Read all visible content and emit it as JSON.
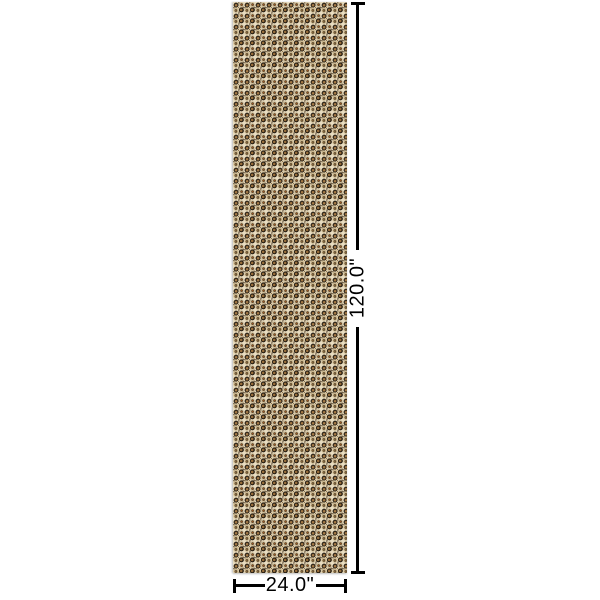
{
  "canvas": {
    "width": 600,
    "height": 600,
    "background": "#ffffff"
  },
  "product": {
    "description": "leopard print panel preview",
    "pattern": {
      "name": "leopard-print",
      "tile_size": 11,
      "background": "#e8ddc2",
      "palette": {
        "cream": "#e8ddc2",
        "tan": "#cdb88e",
        "caramel": "#a57a46",
        "dark_brown": "#33281a",
        "near_black": "#2c2214",
        "rust_orange": "#a85a22"
      },
      "shapes": [
        {
          "cx": 3.0,
          "cy": 8.2,
          "r": 2.6,
          "fill": "#cdb88e"
        },
        {
          "cx": 8.3,
          "cy": 2.8,
          "r": 2.5,
          "fill": "#d2bf9a"
        },
        {
          "cx": 3.1,
          "cy": 3.1,
          "r": 2.5,
          "fill": "#33281a"
        },
        {
          "cx": 3.1,
          "cy": 3.3,
          "r": 1.25,
          "fill": "#a57a46"
        },
        {
          "cx": 8.4,
          "cy": 7.9,
          "r": 2.5,
          "fill": "#2c2214"
        },
        {
          "cx": 8.2,
          "cy": 7.9,
          "r": 1.25,
          "fill": "#996f3c"
        },
        {
          "cx": 8.6,
          "cy": 2.6,
          "r": 1.3,
          "fill": "#4a3a22"
        },
        {
          "cx": 8.6,
          "cy": 2.6,
          "r": 0.65,
          "fill": "#a85a22"
        },
        {
          "cx": 2.9,
          "cy": 8.4,
          "r": 1.3,
          "fill": "#3c2e1c"
        },
        {
          "cx": 2.9,
          "cy": 8.4,
          "r": 0.6,
          "fill": "#b98c50"
        },
        {
          "cx": 5.8,
          "cy": 0.9,
          "r": 0.7,
          "fill": "#57432a"
        },
        {
          "cx": 0.9,
          "cy": 5.7,
          "r": 0.7,
          "fill": "#5a4629"
        },
        {
          "cx": 6.0,
          "cy": 10.2,
          "r": 0.7,
          "fill": "#4e3b24"
        },
        {
          "cx": 10.2,
          "cy": 5.3,
          "r": 0.7,
          "fill": "#46351f"
        },
        {
          "cx": 5.6,
          "cy": 5.6,
          "r": 0.6,
          "fill": "#8a6a3a"
        }
      ]
    }
  },
  "dimensions": {
    "line_color": "#000000",
    "height": {
      "label": "120.0\"",
      "orientation": "vertical"
    },
    "width": {
      "label": "24.0\"",
      "orientation": "horizontal"
    }
  }
}
